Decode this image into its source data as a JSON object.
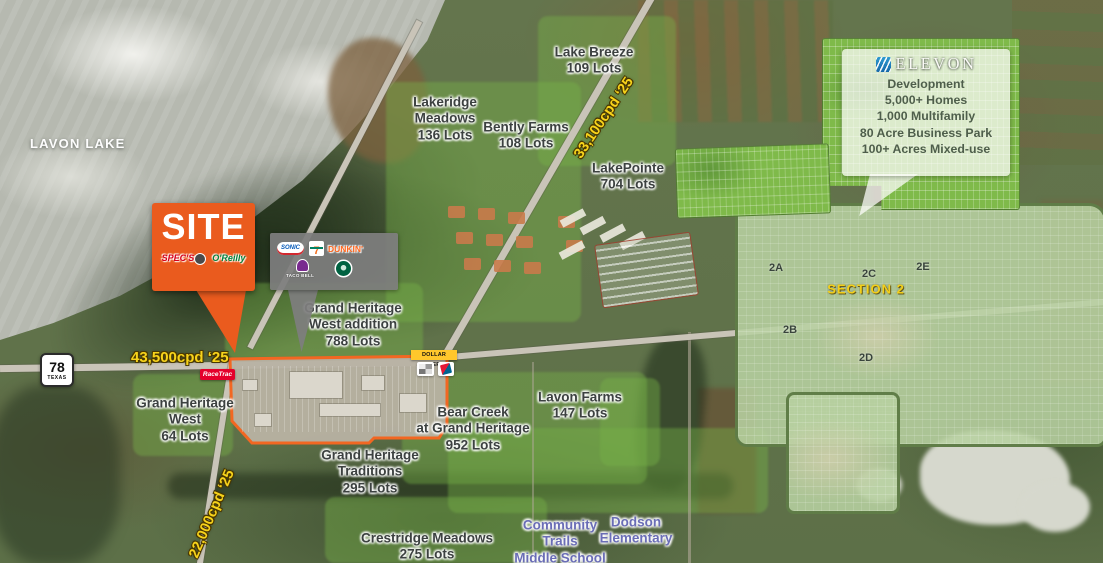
{
  "water": {
    "label": "LAVON LAKE"
  },
  "site_callout": {
    "label": "SITE",
    "logos": {
      "specs": "SPEC'S",
      "oreilly": "O'Reilly"
    }
  },
  "retail_panel": {
    "sonic": "SONIC",
    "seven_eleven": "7",
    "dunkin": "DUNKIN'",
    "taco_bell": "TACO BELL"
  },
  "highway_shield": {
    "number": "78",
    "state": "TEXAS"
  },
  "traffic": {
    "west": "43,500cpd ‘25",
    "north": "33,100cpd ‘25",
    "south": "22,000cpd ‘25"
  },
  "stores": {
    "racetrac": "RaceTrac",
    "dollar_general": "DOLLAR GENERAL"
  },
  "subdivisions": [
    {
      "id": "lake-breeze",
      "lines": [
        "Lake Breeze",
        "109 Lots"
      ]
    },
    {
      "id": "lakeridge-meadows",
      "lines": [
        "Lakeridge",
        "Meadows",
        "136 Lots"
      ]
    },
    {
      "id": "bently-farms",
      "lines": [
        "Bently Farms",
        "108 Lots"
      ]
    },
    {
      "id": "lakepointe",
      "lines": [
        "LakePointe",
        "704 Lots"
      ]
    },
    {
      "id": "grand-heritage-west-addition",
      "lines": [
        "Grand Heritage",
        "West addition",
        "788 Lots"
      ]
    },
    {
      "id": "grand-heritage-west",
      "lines": [
        "Grand Heritage",
        "West",
        "64 Lots"
      ]
    },
    {
      "id": "grand-heritage-traditions",
      "lines": [
        "Grand Heritage",
        "Traditions",
        "295 Lots"
      ]
    },
    {
      "id": "bear-creek",
      "lines": [
        "Bear Creek",
        "at Grand Heritage",
        "952 Lots"
      ]
    },
    {
      "id": "lavon-farms",
      "lines": [
        "Lavon Farms",
        "147 Lots"
      ]
    },
    {
      "id": "crestridge-meadows",
      "lines": [
        "Crestridge Meadows",
        "275 Lots"
      ]
    }
  ],
  "schools": [
    {
      "id": "community-trails",
      "lines": [
        "Community",
        "Trails",
        "Middle School"
      ]
    },
    {
      "id": "dodson",
      "lines": [
        "Dodson",
        "Elementary"
      ]
    }
  ],
  "elevon": {
    "brand": "ELEVON",
    "lines": [
      "Development",
      "5,000+ Homes",
      "1,000 Multifamily",
      "80 Acre Business Park",
      "100+ Acres Mixed-use"
    ]
  },
  "sections": {
    "title": "SECTION 2",
    "labels": [
      "2A",
      "2B",
      "2C",
      "2D",
      "2E"
    ]
  },
  "icons": {
    "starbucks": "starbucks-siren-circle",
    "dominos": "dominos-tile",
    "taco_bell": "taco-bell-bell",
    "specs_mascot": "specs-terrier-head",
    "elevon_mark": "elevon-wave-square",
    "bw_chip": "bw-storefront-logo"
  },
  "colors": {
    "site_orange": "#EA5B1E",
    "traffic_yellow": "#F7D31B",
    "label_dark": "#3C4140",
    "school_purple": "#6A6DB6",
    "section_yellow": "#F3CF1A",
    "elevon_text": "#4E5E4B",
    "racetrac_red": "#E4002B",
    "dollar_general_yellow": "#FFC72C",
    "dunkin_orange": "#FF671F",
    "starbucks_green": "#006241",
    "taco_bell_purple": "#792A8F",
    "sonic_blue": "#0057B8",
    "oreilly_green": "#00833E",
    "specs_red": "#D6001C",
    "plan_bright_green": "#7FBA4A",
    "section_sage": "#B7D0A0"
  }
}
